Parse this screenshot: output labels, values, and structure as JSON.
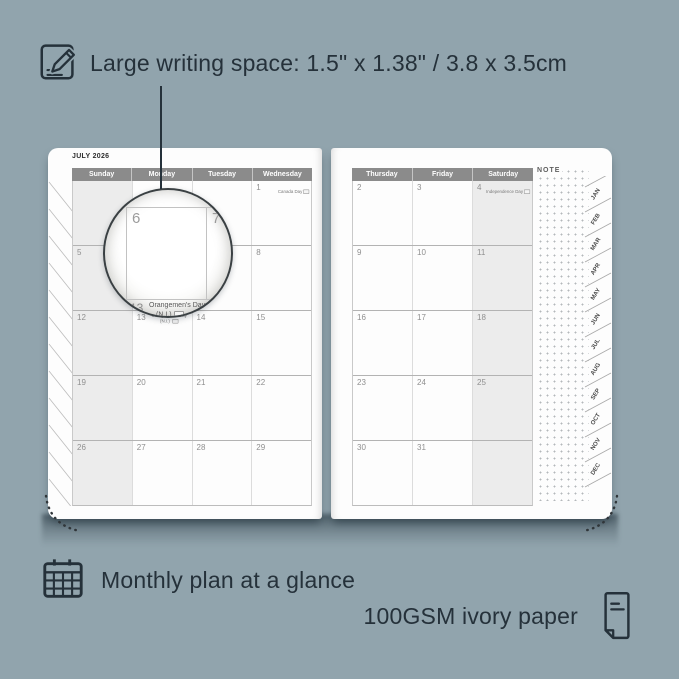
{
  "colors": {
    "bg": "#91a4ad",
    "ink": "#25313a",
    "page": "#fdfdfd",
    "headerbg": "#8b8b8b",
    "shade": "#ececec"
  },
  "annotations": {
    "top": "Large writing space: 1.5\" x 1.38\" / 3.8 x 3.5cm",
    "bottom_left": "Monthly plan at a glance",
    "bottom_right": "100GSM ivory paper"
  },
  "planner": {
    "title": "JULY 2026",
    "note_label": "NOTE",
    "month_tabs": [
      "JAN",
      "FEB",
      "MAR",
      "APR",
      "MAY",
      "JUN",
      "JUL",
      "AUG",
      "SEP",
      "OCT",
      "NOV",
      "DEC"
    ],
    "left_page": {
      "headers": [
        "Sunday",
        "Monday",
        "Tuesday",
        "Wednesday"
      ],
      "shaded_column": 0,
      "weeks": [
        [
          {
            "day": ""
          },
          {
            "day": ""
          },
          {
            "day": ""
          },
          {
            "day": "1",
            "holiday": "Canada Day",
            "flag": true,
            "align": "right"
          }
        ],
        [
          {
            "day": "5"
          },
          {
            "day": "6"
          },
          {
            "day": "7"
          },
          {
            "day": "8"
          }
        ],
        [
          {
            "day": "12"
          },
          {
            "day": "13",
            "holiday": "Orangemen's Day",
            "holiday2": "(N.I.)",
            "flag": true,
            "align": "center"
          },
          {
            "day": "14"
          },
          {
            "day": "15"
          }
        ],
        [
          {
            "day": "19"
          },
          {
            "day": "20"
          },
          {
            "day": "21"
          },
          {
            "day": "22"
          }
        ],
        [
          {
            "day": "26"
          },
          {
            "day": "27"
          },
          {
            "day": "28"
          },
          {
            "day": "29"
          }
        ]
      ]
    },
    "right_page": {
      "headers": [
        "Thursday",
        "Friday",
        "Saturday"
      ],
      "shaded_column": 2,
      "weeks": [
        [
          {
            "day": "2"
          },
          {
            "day": "3"
          },
          {
            "day": "4",
            "holiday": "Independence Day",
            "flag": true,
            "align": "right"
          }
        ],
        [
          {
            "day": "9"
          },
          {
            "day": "10"
          },
          {
            "day": "11"
          }
        ],
        [
          {
            "day": "16"
          },
          {
            "day": "17"
          },
          {
            "day": "18"
          }
        ],
        [
          {
            "day": "23"
          },
          {
            "day": "24"
          },
          {
            "day": "25"
          }
        ],
        [
          {
            "day": "30"
          },
          {
            "day": "31"
          },
          {
            "day": ""
          }
        ]
      ]
    },
    "magnifier": {
      "left_day": "6",
      "right_day": "7",
      "below_day": "13",
      "holiday_line1": "Orangemen's Day",
      "holiday_line2": "(N.I.)"
    }
  }
}
